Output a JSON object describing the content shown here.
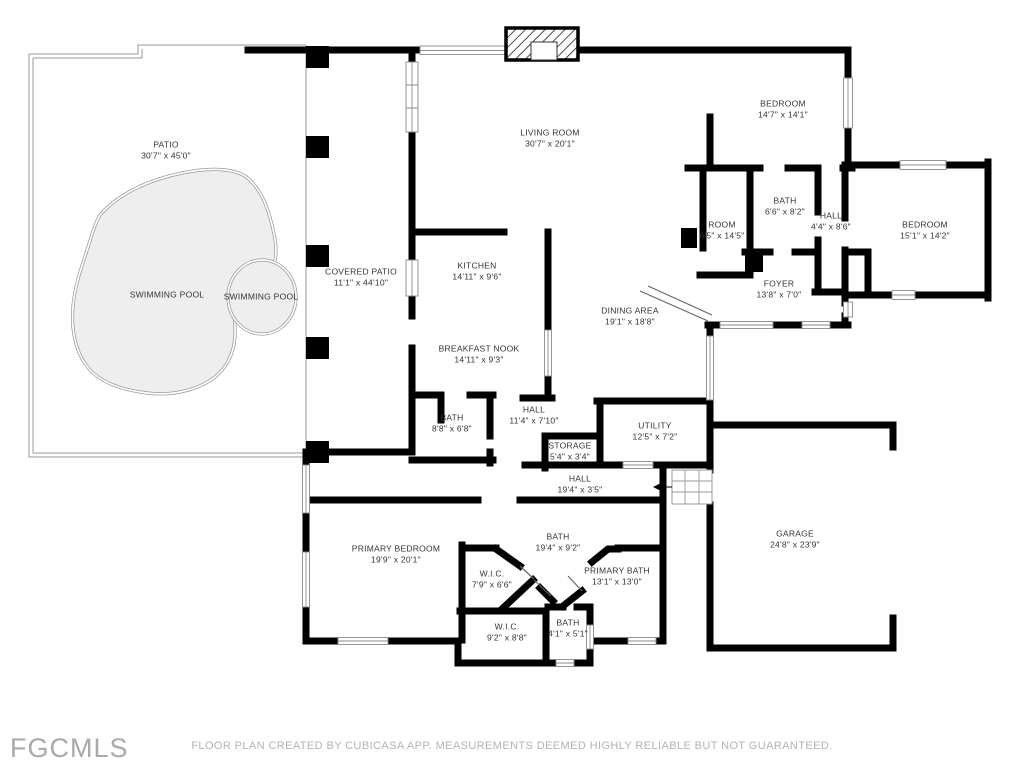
{
  "footer": {
    "logo": "FGCMLS",
    "disclaimer": "FLOOR PLAN CREATED BY CUBICASA APP. MEASUREMENTS DEEMED HIGHLY RELIABLE BUT NOT GUARANTEED."
  },
  "colors": {
    "wall": "#000000",
    "pool_fill": "#eeeeee",
    "outline": "#9a9a9a",
    "label_text": "#333333",
    "watermark_text": "#a9a9a9"
  },
  "rooms": [
    {
      "name": "PATIO",
      "dims": "30'7\" x 45'0\""
    },
    {
      "name": "SWIMMING POOL",
      "dims": ""
    },
    {
      "name": "SWIMMING POOL",
      "dims": ""
    },
    {
      "name": "COVERED PATIO",
      "dims": "11'1\" x 44'10\""
    },
    {
      "name": "LIVING ROOM",
      "dims": "30'7\" x 20'1\""
    },
    {
      "name": "KITCHEN",
      "dims": "14'11\" x 9'6\""
    },
    {
      "name": "BREAKFAST NOOK",
      "dims": "14'11\" x 9'3\""
    },
    {
      "name": "BEDROOM",
      "dims": "14'7\" x 14'1\""
    },
    {
      "name": "BATH",
      "dims": "6'6\" x 8'2\""
    },
    {
      "name": "ROOM",
      "dims": "6'5\" x 14'5\""
    },
    {
      "name": "HALL",
      "dims": "4'4\" x 8'6\""
    },
    {
      "name": "BEDROOM",
      "dims": "15'1\" x 14'2\""
    },
    {
      "name": "FOYER",
      "dims": "13'8\" x 7'0\""
    },
    {
      "name": "DINING AREA",
      "dims": "19'1\" x 18'8\""
    },
    {
      "name": "BATH",
      "dims": "8'8\" x 6'8\""
    },
    {
      "name": "HALL",
      "dims": "11'4\" x 7'10\""
    },
    {
      "name": "STORAGE",
      "dims": "5'4\" x 3'4\""
    },
    {
      "name": "UTILITY",
      "dims": "12'5\" x 7'2\""
    },
    {
      "name": "HALL",
      "dims": "19'4\" x 3'5\""
    },
    {
      "name": "PRIMARY BEDROOM",
      "dims": "19'9\" x 20'1\""
    },
    {
      "name": "W.I.C.",
      "dims": "7'9\" x 6'6\""
    },
    {
      "name": "BATH",
      "dims": "19'4\" x 9'2\""
    },
    {
      "name": "PRIMARY BATH",
      "dims": "13'1\" x 13'0\""
    },
    {
      "name": "W.I.C.",
      "dims": "9'2\" x 8'8\""
    },
    {
      "name": "BATH",
      "dims": "4'1\" x 5'1\""
    },
    {
      "name": "GARAGE",
      "dims": "24'8\" x 23'9\""
    }
  ]
}
